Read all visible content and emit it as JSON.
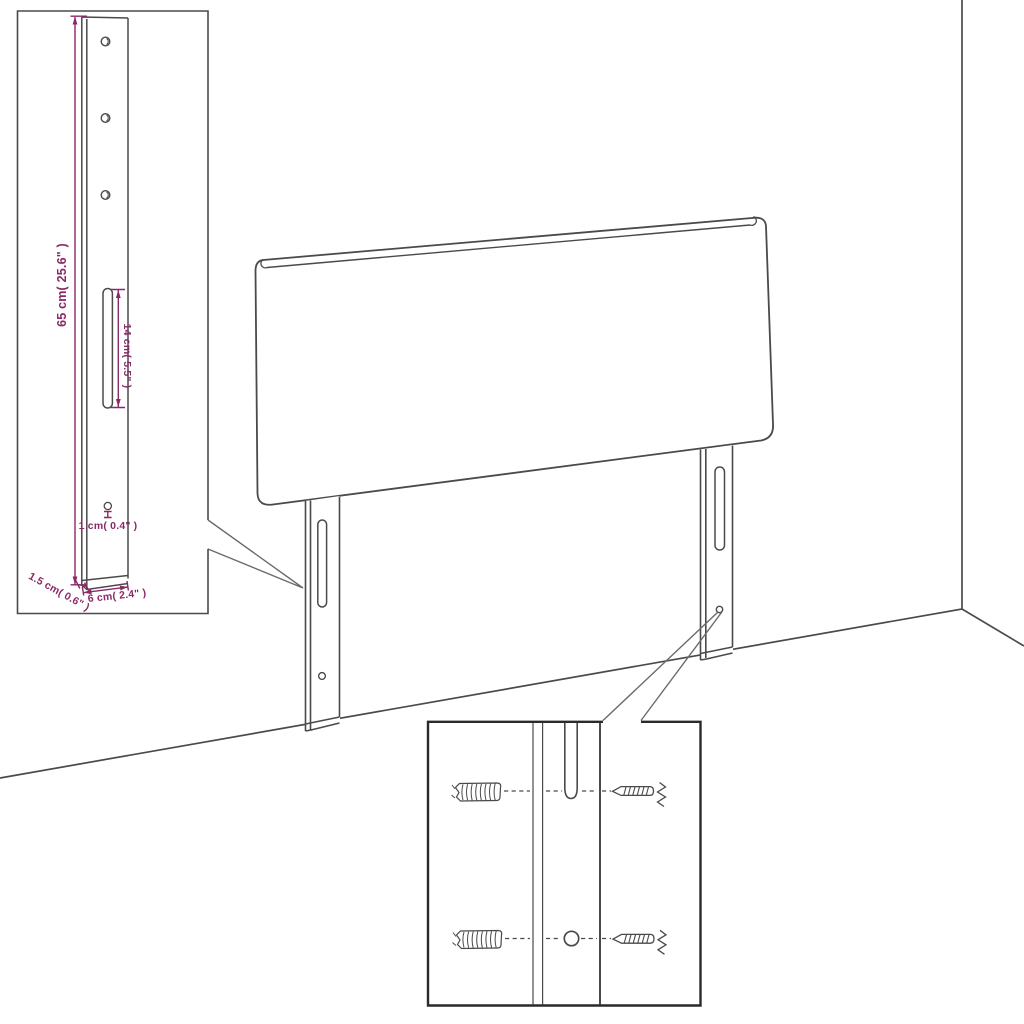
{
  "page": {
    "background": "#ffffff",
    "subject": "headboard-assembly-diagram"
  },
  "palette": {
    "line": "#4a4a4a",
    "line_dark": "#2a2a2a",
    "callout": "#6b6b6b",
    "dimension": "#8a2968",
    "fill": "#ffffff"
  },
  "leg_detail_inset": {
    "dim_height": "65 cm( 25.6\" )",
    "dim_slot": "14 cm( 5.5\" )",
    "dim_hole": "1 cm( 0.4\" )",
    "dim_thickness": "1.5 cm( 0.6\" )",
    "dim_width": "6 cm( 2.4\" )"
  }
}
